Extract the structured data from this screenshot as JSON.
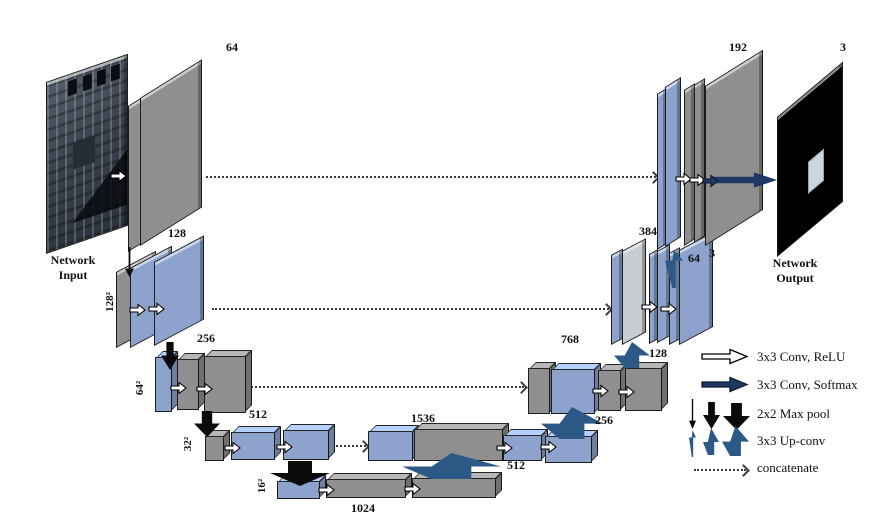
{
  "diagram": {
    "title": "U-Net encoder-decoder architecture",
    "input_caption": "Network\nInput",
    "output_caption": "Network\nOutput"
  },
  "labels": {
    "enc64": "64",
    "enc128": "128",
    "enc256": "256",
    "enc512": "512",
    "enc1024": "1024",
    "size128": "128²",
    "size64": "64²",
    "size32": "32²",
    "size16": "16²",
    "dec1536": "1536",
    "dec512": "512",
    "up256": "256",
    "dec768": "768",
    "up128": "128",
    "dec384": "384",
    "up64": "64",
    "dec3": "3",
    "dec192": "192",
    "out3": "3"
  },
  "legend": {
    "items": [
      {
        "icon": "conv-relu-arrow",
        "label": "3x3 Conv, ReLU"
      },
      {
        "icon": "conv-softmax-arrow",
        "label": "3x3 Conv, Softmax"
      },
      {
        "icon": "max-pool-arrows",
        "label": "2x2 Max pool"
      },
      {
        "icon": "up-conv-arrows",
        "label": "3x3 Up-conv"
      },
      {
        "icon": "concatenate-arrow",
        "label": "concatenate"
      }
    ]
  },
  "colors": {
    "feature_blue": "#8da3cd",
    "feature_gray": "#8f8f8f",
    "concat_gray": "#c9ccd1",
    "softmax_navy": "#1f3864",
    "upconv_blue": "#2d5986",
    "maxpool_black": "#0b0b0b",
    "background": "#ffffff"
  }
}
